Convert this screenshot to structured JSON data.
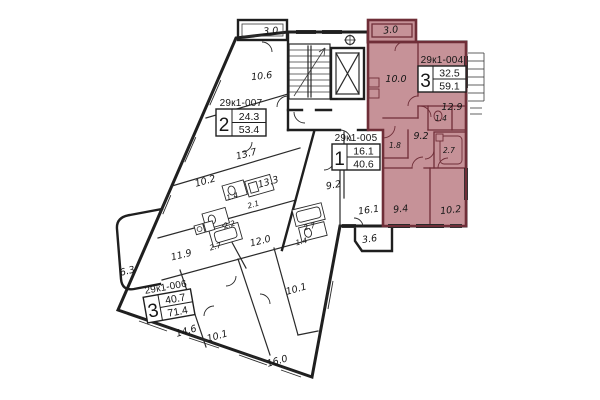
{
  "apartments": {
    "apt_007": {
      "id": "29к1-007",
      "rooms_count": "2",
      "living_area": "24.3",
      "total_area": "53.4",
      "rooms": {
        "balcony": "3.0",
        "room_1": "10.6",
        "room_2": "13.7",
        "corridor": "10.2",
        "kitchen": "13.3",
        "wc": "1.4",
        "bath": "2.1"
      }
    },
    "apt_004": {
      "id": "29к1-004",
      "rooms_count": "3",
      "living_area": "32.5",
      "total_area": "59.1",
      "highlighted": true,
      "rooms": {
        "balcony": "3.0",
        "kitchen": "10.0",
        "living": "12.9",
        "wc": "1.4",
        "hall": "9.2",
        "closet": "1.8",
        "bath": "2.7",
        "bedroom_1": "9.4",
        "bedroom_2": "10.2"
      }
    },
    "apt_005": {
      "id": "29к1-005",
      "rooms_count": "1",
      "living_area": "16.1",
      "total_area": "40.6",
      "rooms": {
        "kitchen": "9.2",
        "living": "16.1",
        "bath": "2.7",
        "wc": "1.4",
        "hall": "10.1",
        "balcony": "3.6"
      }
    },
    "apt_006": {
      "id": "29к1-006",
      "rooms_count": "3",
      "living_area": "40.7",
      "total_area": "71.4",
      "rooms": {
        "kitchen": "11.9",
        "corridor": "12.0",
        "bath": "2.2",
        "bath_2": "2.7",
        "balcony": "6.3",
        "room_1": "14.6",
        "room_2": "10.1",
        "room_3": "16.0"
      }
    }
  },
  "colors": {
    "highlight_fill": "#c69298",
    "highlight_wall": "#6f2e38",
    "wall": "#1f1f1f",
    "background": "#ffffff"
  }
}
